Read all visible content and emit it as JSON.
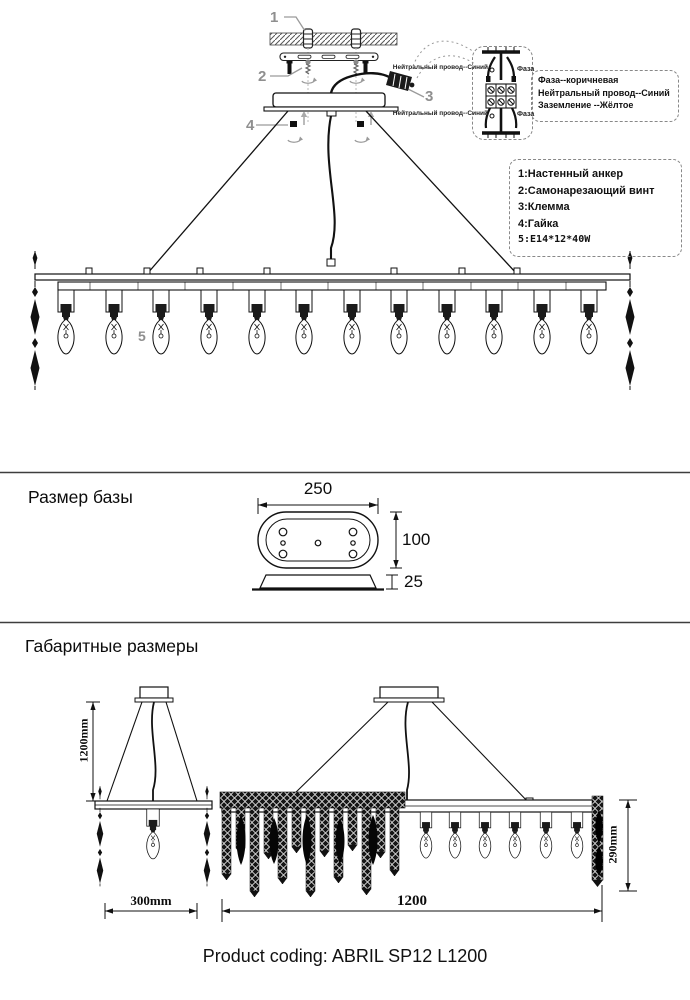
{
  "install": {
    "callout_1": "1",
    "callout_2": "2",
    "callout_3": "3",
    "callout_4": "4",
    "callout_5": "5",
    "wiring_labels": {
      "neutral_top": "Нейтральный провод--Синий",
      "phase_top": "Фаза",
      "neutral_bottom": "Нейтральный провод--Синий",
      "phase_bottom": "Фаза"
    },
    "wire_legend": {
      "line1": "Фаза--коричневая",
      "line2": "Нейтральный провод--Синий",
      "line3": "Заземление --Жёлтое"
    },
    "parts_list": {
      "item1": "1:Настенный анкер",
      "item2": "2:Самонарезающий винт",
      "item3": "3:Клемма",
      "item4": "4:Гайка",
      "item5": "5:E14*12*40W"
    }
  },
  "base_section": {
    "title": "Размер базы",
    "dim_width": "250",
    "dim_depth": "100",
    "dim_thickness": "25"
  },
  "overall_section": {
    "title": "Габаритные размеры",
    "dim_drop_height": "1200mm",
    "dim_side_width": "300mm",
    "dim_length": "1200",
    "dim_body_height": "290mm"
  },
  "footer": {
    "product_coding": "Product coding: ABRIL SP12 L1200"
  }
}
